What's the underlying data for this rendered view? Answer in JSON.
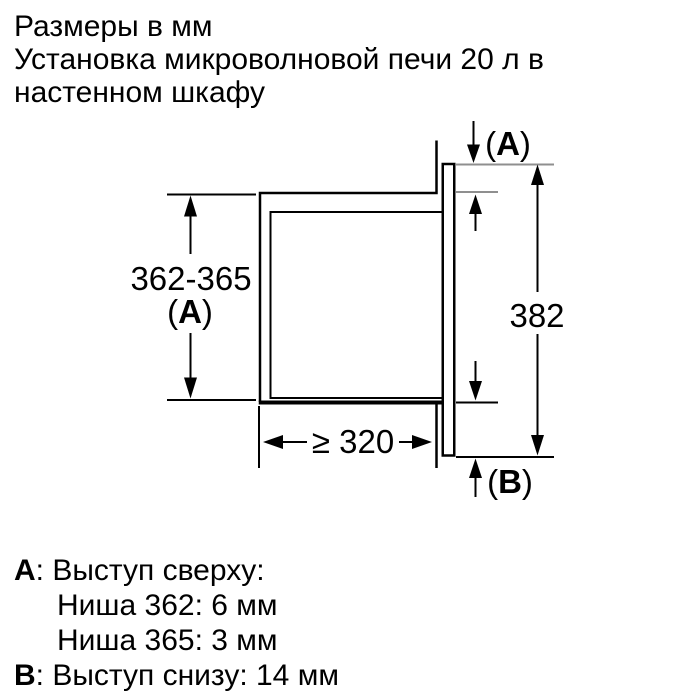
{
  "header": {
    "line1": "Размеры в мм",
    "line2": "Установка микроволновой печи 20 л в",
    "line3": "настенном шкафу"
  },
  "diagram": {
    "niche_height": "362-365",
    "niche_height_ref": {
      "open": "(",
      "letter": "A",
      "close": ")"
    },
    "front_frame_height": "382",
    "niche_depth": "≥ 320",
    "top_protrusion_ref": {
      "open": "(",
      "letter": "A",
      "close": ")"
    },
    "bottom_protrusion_ref": {
      "open": "(",
      "letter": "B",
      "close": ")"
    },
    "colors": {
      "line_black": "#000000",
      "extension_gray": "#8f8f8f"
    }
  },
  "legend": {
    "item_a": {
      "label": "A",
      "text": ": Выступ сверху:"
    },
    "item_a_row1": "Ниша 362: 6 мм",
    "item_a_row2": "Ниша 365: 3 мм",
    "item_b": {
      "label": "B",
      "text": ": Выступ снизу: 14 мм"
    }
  }
}
